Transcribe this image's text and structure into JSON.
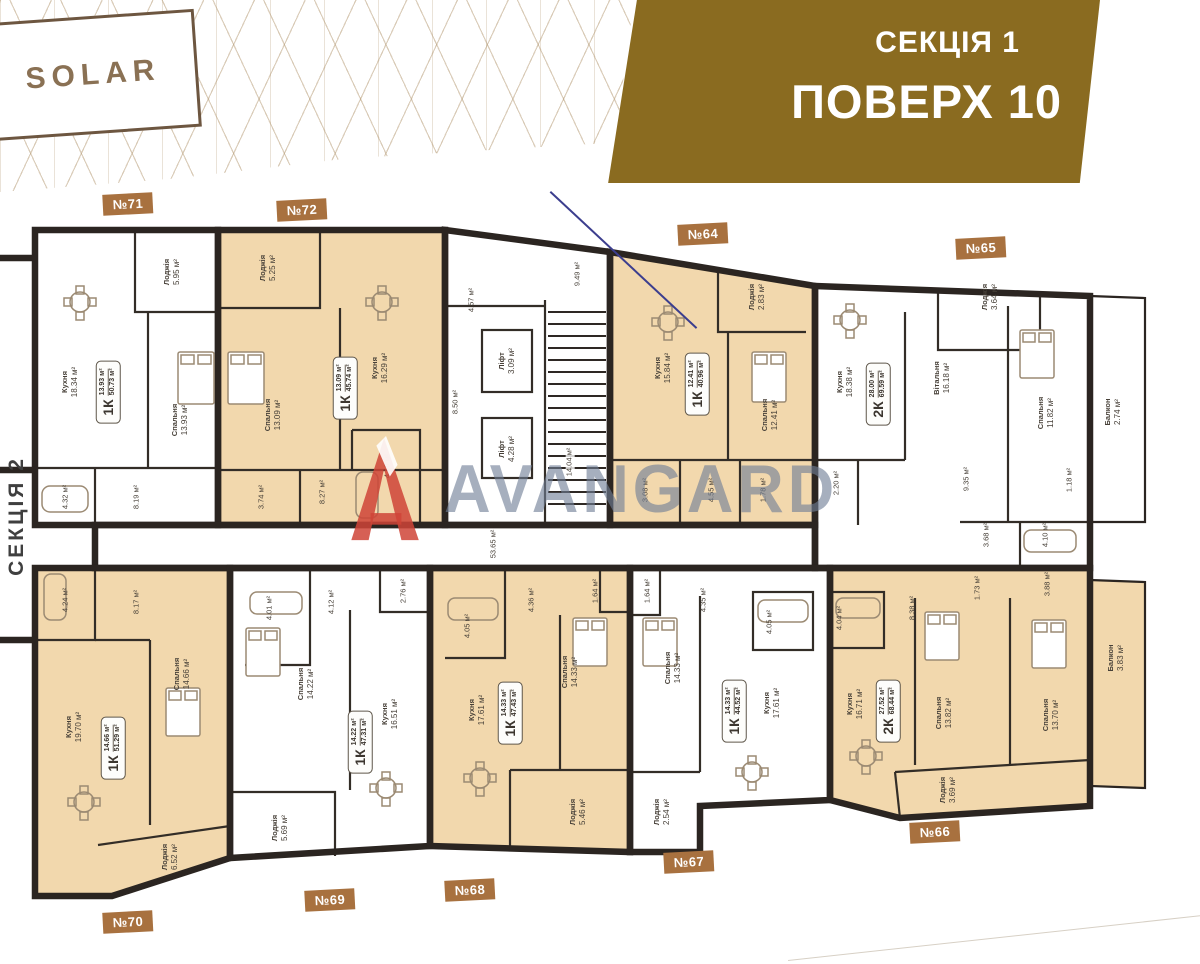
{
  "branding": {
    "logo": "SOLAR",
    "watermark": "AVANGARD"
  },
  "banner": {
    "section": "СЕКЦІЯ 1",
    "floor": "ПОВЕРХ 10"
  },
  "side_section_label": "СЕКЦІЯ 2",
  "common": {
    "corridor_area": "53.65 м²",
    "upper_hall_area": "4.57 м²",
    "upper_corridor_area": "9.49 м²",
    "left_hall_area": "8.50 м²",
    "lift1_name": "Ліфт",
    "lift1_area": "3.09 м²",
    "lift2_name": "Ліфт",
    "lift2_area": "4.28 м²",
    "stairs_area": "14.04 м²"
  },
  "apartments": [
    {
      "number": "№71",
      "type": "1К",
      "living_area": "13.93 м²",
      "total_area": "50.73 м²",
      "rooms": [
        {
          "name": "Кухня",
          "area": "18.34 м²"
        },
        {
          "name": "Спальня",
          "area": "13.93 м²"
        },
        {
          "name": "Лоджія",
          "area": "5.95 м²"
        }
      ],
      "extra_areas": [
        "4.32 м²",
        "8.19 м²"
      ]
    },
    {
      "number": "№72",
      "type": "1К",
      "living_area": "13.09 м²",
      "total_area": "45.74 м²",
      "rooms": [
        {
          "name": "Кухня",
          "area": "16.29 м²"
        },
        {
          "name": "Спальня",
          "area": "13.09 м²"
        },
        {
          "name": "Лоджія",
          "area": "5.25 м²"
        }
      ],
      "extra_areas": [
        "8.27 м²",
        "4.10 м²",
        "3.74 м²"
      ]
    },
    {
      "number": "№64",
      "type": "1К",
      "living_area": "12.41 м²",
      "total_area": "40.96 м²",
      "rooms": [
        {
          "name": "Кухня",
          "area": "15.84 м²"
        },
        {
          "name": "Спальня",
          "area": "12.41 м²"
        },
        {
          "name": "Лоджія",
          "area": "2.83 м²"
        }
      ],
      "extra_areas": [
        "3.08 м²",
        "4.55 м²",
        "1.78 м²"
      ]
    },
    {
      "number": "№65",
      "type": "2К",
      "living_area": "28.00 м²",
      "total_area": "69.59 м²",
      "rooms": [
        {
          "name": "Кухня",
          "area": "18.38 м²"
        },
        {
          "name": "Вітальня",
          "area": "16.18 м²"
        },
        {
          "name": "Спальня",
          "area": "11.82 м²"
        },
        {
          "name": "Лоджія",
          "area": "3.64 м²"
        },
        {
          "name": "Балкон",
          "area": "2.74 м²"
        }
      ],
      "extra_areas": [
        "2.20 м²",
        "9.35 м²",
        "1.18 м²",
        "4.10 м²",
        "3.68 м²"
      ]
    },
    {
      "number": "№70",
      "type": "1К",
      "living_area": "14.66 м²",
      "total_area": "51.29 м²",
      "rooms": [
        {
          "name": "Кухня",
          "area": "19.70 м²"
        },
        {
          "name": "Спальня",
          "area": "14.66 м²"
        },
        {
          "name": "Лоджія",
          "area": "6.52 м²"
        }
      ],
      "extra_areas": [
        "4.24 м²",
        "8.17 м²"
      ]
    },
    {
      "number": "№69",
      "type": "1К",
      "living_area": "14.22 м²",
      "total_area": "47.31 м²",
      "rooms": [
        {
          "name": "Кухня",
          "area": "16.51 м²"
        },
        {
          "name": "Спальня",
          "area": "14.22 м²"
        },
        {
          "name": "Лоджія",
          "area": "5.69 м²"
        }
      ],
      "extra_areas": [
        "4.01 м²",
        "4.12 м²",
        "2.76 м²"
      ]
    },
    {
      "number": "№68",
      "type": "1К",
      "living_area": "14.33 м²",
      "total_area": "47.43 м²",
      "rooms": [
        {
          "name": "Кухня",
          "area": "17.61 м²"
        },
        {
          "name": "Спальня",
          "area": "14.33 м²"
        },
        {
          "name": "Лоджія",
          "area": "5.46 м²"
        }
      ],
      "extra_areas": [
        "4.05 м²",
        "4.36 м²",
        "1.64 м²"
      ]
    },
    {
      "number": "№67",
      "type": "1К",
      "living_area": "14.33 м²",
      "total_area": "44.52 м²",
      "rooms": [
        {
          "name": "Кухня",
          "area": "17.61 м²"
        },
        {
          "name": "Спальня",
          "area": "14.33 м²"
        },
        {
          "name": "Лоджія",
          "area": "2.54 м²"
        }
      ],
      "extra_areas": [
        "4.05 м²",
        "4.35 м²",
        "1.64 м²"
      ]
    },
    {
      "number": "№66",
      "type": "2К",
      "living_area": "27.52 м²",
      "total_area": "68.44 м²",
      "rooms": [
        {
          "name": "Кухня",
          "area": "16.71 м²"
        },
        {
          "name": "Спальня",
          "area": "13.82 м²"
        },
        {
          "name": "Спальня",
          "area": "13.70 м²"
        },
        {
          "name": "Лоджія",
          "area": "3.69 м²"
        },
        {
          "name": "Балкон",
          "area": "3.83 м²"
        }
      ],
      "extra_areas": [
        "4.04 м²",
        "8.38 м²",
        "1.73 м²",
        "3.88 м²"
      ]
    }
  ]
}
